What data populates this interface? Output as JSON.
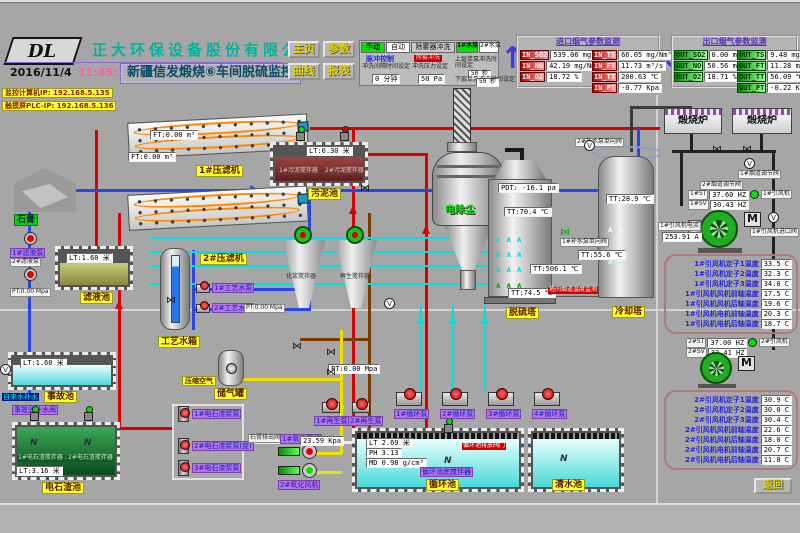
{
  "header": {
    "company": "正大环保设备股份有限公司",
    "logo": "DL",
    "date": "2016/11/4",
    "time": "11:45:10",
    "title": "新疆信发煅烧⑥车间脱硫监控",
    "nav": {
      "home": "主页",
      "params": "参数",
      "curve": "曲线",
      "report": "报表"
    },
    "mode": {
      "manual": "手动",
      "auto": "自动",
      "demister": "除雾器冲洗",
      "pump1": "1#水泵",
      "pump2": "2#水泵",
      "pulse": "脉冲控制",
      "flush": "除雾冲洗",
      "interval_label": "冲洗间隔时间设定",
      "interval_value": "0 分钟",
      "pressure_label": "冲洗压力设定",
      "pressure_value": "50 Pa",
      "upper_label": "上层单泵冲洗时间设定",
      "upper_value": "50 秒",
      "lower_label": "下层单泵冲洗时间设定",
      "lower_value": "50 秒"
    },
    "inlet": {
      "title": "进口烟气参数监测",
      "rows": [
        {
          "tag": "IN_SO2",
          "text": "539.06 mg/Nm³"
        },
        {
          "tag": "IN_NO",
          "text": "42.19 mg/Nm³"
        },
        {
          "tag": "IN_O2",
          "text": "18.72 %"
        },
        {
          "tag": "IN_TS",
          "text": "66.05 mg/Nm³"
        },
        {
          "tag": "IN_FT",
          "text": "11.73 m³/s"
        },
        {
          "tag": "IN_TT",
          "text": "200.63 ℃"
        },
        {
          "tag": "IN_PT",
          "text": "-0.77 Kpa"
        }
      ]
    },
    "outlet": {
      "title": "出口烟气参数监测",
      "rows": [
        {
          "tag": "OUT_SO2",
          "text": "0.00 mg/Nm³"
        },
        {
          "tag": "OUT_NO",
          "text": "50.56 mg/Nm³"
        },
        {
          "tag": "OUT_O2",
          "text": "18.71 %"
        },
        {
          "tag": "OUT_TS",
          "text": "9.48 mg/Nm³"
        },
        {
          "tag": "OUT_FT",
          "text": "11.28 m³/s"
        },
        {
          "tag": "OUT_TT",
          "text": "56.09 ℃"
        },
        {
          "tag": "OUT_PT",
          "text": "-0.22 Kpa"
        }
      ]
    }
  },
  "network": {
    "pc_ip": "监控计算机IP: 192.168.5.135",
    "plc_ip": "触摸屏PLC-IP: 192.168.5.136"
  },
  "left": {
    "filter1": "1#压滤机",
    "filter2": "2#压滤机",
    "gypsum": "石膏",
    "flow1": "FT:0.00 m³",
    "flow2": "FT:0.00 m³",
    "filtrate": {
      "name": "滤液池",
      "level": "LT:1.60 米",
      "pump1": "1#滤液泵",
      "pump2": "2#滤液泵",
      "pt": "PT:0.00 Mpa"
    },
    "accident": {
      "name": "事故池",
      "level": "LT:1.60 米",
      "makeup": "自来水补水",
      "valve": "事故池补水阀"
    },
    "carbide": {
      "name": "电石渣池",
      "level": "LT:3.16 米",
      "mixer1": "1#电石渣搅拌器",
      "mixer2": "2#电石渣搅拌器"
    },
    "slurry_pump1": "1#电石渣浆泵",
    "slurry_pump2": "2#电石渣浆泵(变)",
    "slurry_pump3": "3#电石渣浆泵",
    "gypsum_valve": "石膏排出阀"
  },
  "center": {
    "sludge": {
      "name": "污泥池",
      "level": "LT:0.30 米",
      "mixer1": "1#污泥搅拌器",
      "mixer2": "2#污泥搅拌器"
    },
    "water_tank": {
      "name": "工艺水箱",
      "pump1": "1#工艺水泵",
      "pump2": "2#工艺水泵",
      "pt": "PT:0.00 Mpa"
    },
    "air_tank": {
      "name": "储气罐",
      "air": "压缩空气"
    },
    "mixer_a": "化浆搅拌器",
    "mixer_b": "再生搅拌器",
    "esp": "电除尘",
    "fgd": {
      "name": "脱硫塔",
      "pdt": "PDT: -16.1 pa",
      "tt_mid": "TT:70.4 ℃",
      "tt_btm": "TT:74.5 ℃"
    },
    "cooling": {
      "name": "冷却塔",
      "tt_top": "TT:28.9 ℃",
      "tt_mid": "TT:55.6 ℃",
      "check1": "1#补水泵单向阀",
      "check2": "2#补水泵单向阀"
    },
    "duct_tt": "TT:506.1 ℃",
    "duct_note": "塔间烟道温度监测",
    "circ": {
      "name": "循环池",
      "level": "LT 2.69 米",
      "ph": "PH 3.13",
      "dens": "MD 0.98 g/cm³",
      "mixer": "循环池底搅拌器",
      "drain": "循环池排放阀门"
    },
    "clear": "清水池",
    "regen1": "1#再生泵",
    "regen2": "2#再生泵",
    "circ_pump1": "1#循环泵",
    "circ_pump2": "2#循环泵",
    "circ_pump3": "3#循环泵",
    "circ_pump4": "4#循环泵",
    "oxy1": "1#氧化风机",
    "oxy2": "2#氧化风机",
    "kpa": "23.59 Kpa",
    "pt": "PT:0.00 Mpa"
  },
  "right": {
    "furnace1": "煅烧炉",
    "furnace2": "煅烧炉",
    "damper1": "1#烟道调节阀",
    "damper2": "2#烟道调节阀",
    "fan1": {
      "name": "1#引风机",
      "st": "1#ST",
      "st_v": "37.60 HZ",
      "sv": "1#SV",
      "sv_v": "30.43 HZ",
      "amp_label": "1#引风机电流",
      "amp": "253.91 A",
      "inlet_valve": "1#引风机进口阀",
      "motor": "M"
    },
    "fan1_temps": [
      {
        "label": "1#引风机定子1温度",
        "value": "33.5 C"
      },
      {
        "label": "1#引风机定子2温度",
        "value": "32.3 C"
      },
      {
        "label": "1#引风机定子3温度",
        "value": "34.0 C"
      },
      {
        "label": "1#引风机风机前轴温度",
        "value": "17.5 C"
      },
      {
        "label": "1#引风机风机后轴温度",
        "value": "19.6 C"
      },
      {
        "label": "1#引风机电机前轴温度",
        "value": "20.3 C"
      },
      {
        "label": "1#引风机电机后轴温度",
        "value": "18.7 C"
      }
    ],
    "fan2": {
      "name": "2#引风机",
      "st": "2#ST",
      "st_v": "37.00 HZ",
      "sv": "2#SV",
      "sv_v": "33.41 HZ",
      "motor": "M"
    },
    "fan2_temps": [
      {
        "label": "2#引风机定子1温度",
        "value": "30.9 C"
      },
      {
        "label": "2#引风机定子2温度",
        "value": "30.0 C"
      },
      {
        "label": "2#引风机定子3温度",
        "value": "30.4 C"
      },
      {
        "label": "2#引风机风机前轴温度",
        "value": "22.6 C"
      },
      {
        "label": "2#引风机风机后轴温度",
        "value": "18.0 C"
      },
      {
        "label": "2#引风机电机前轴温度",
        "value": "20.7 C"
      },
      {
        "label": "2#引风机电机后轴温度",
        "value": "11.8 C"
      }
    ],
    "back": "返回"
  }
}
